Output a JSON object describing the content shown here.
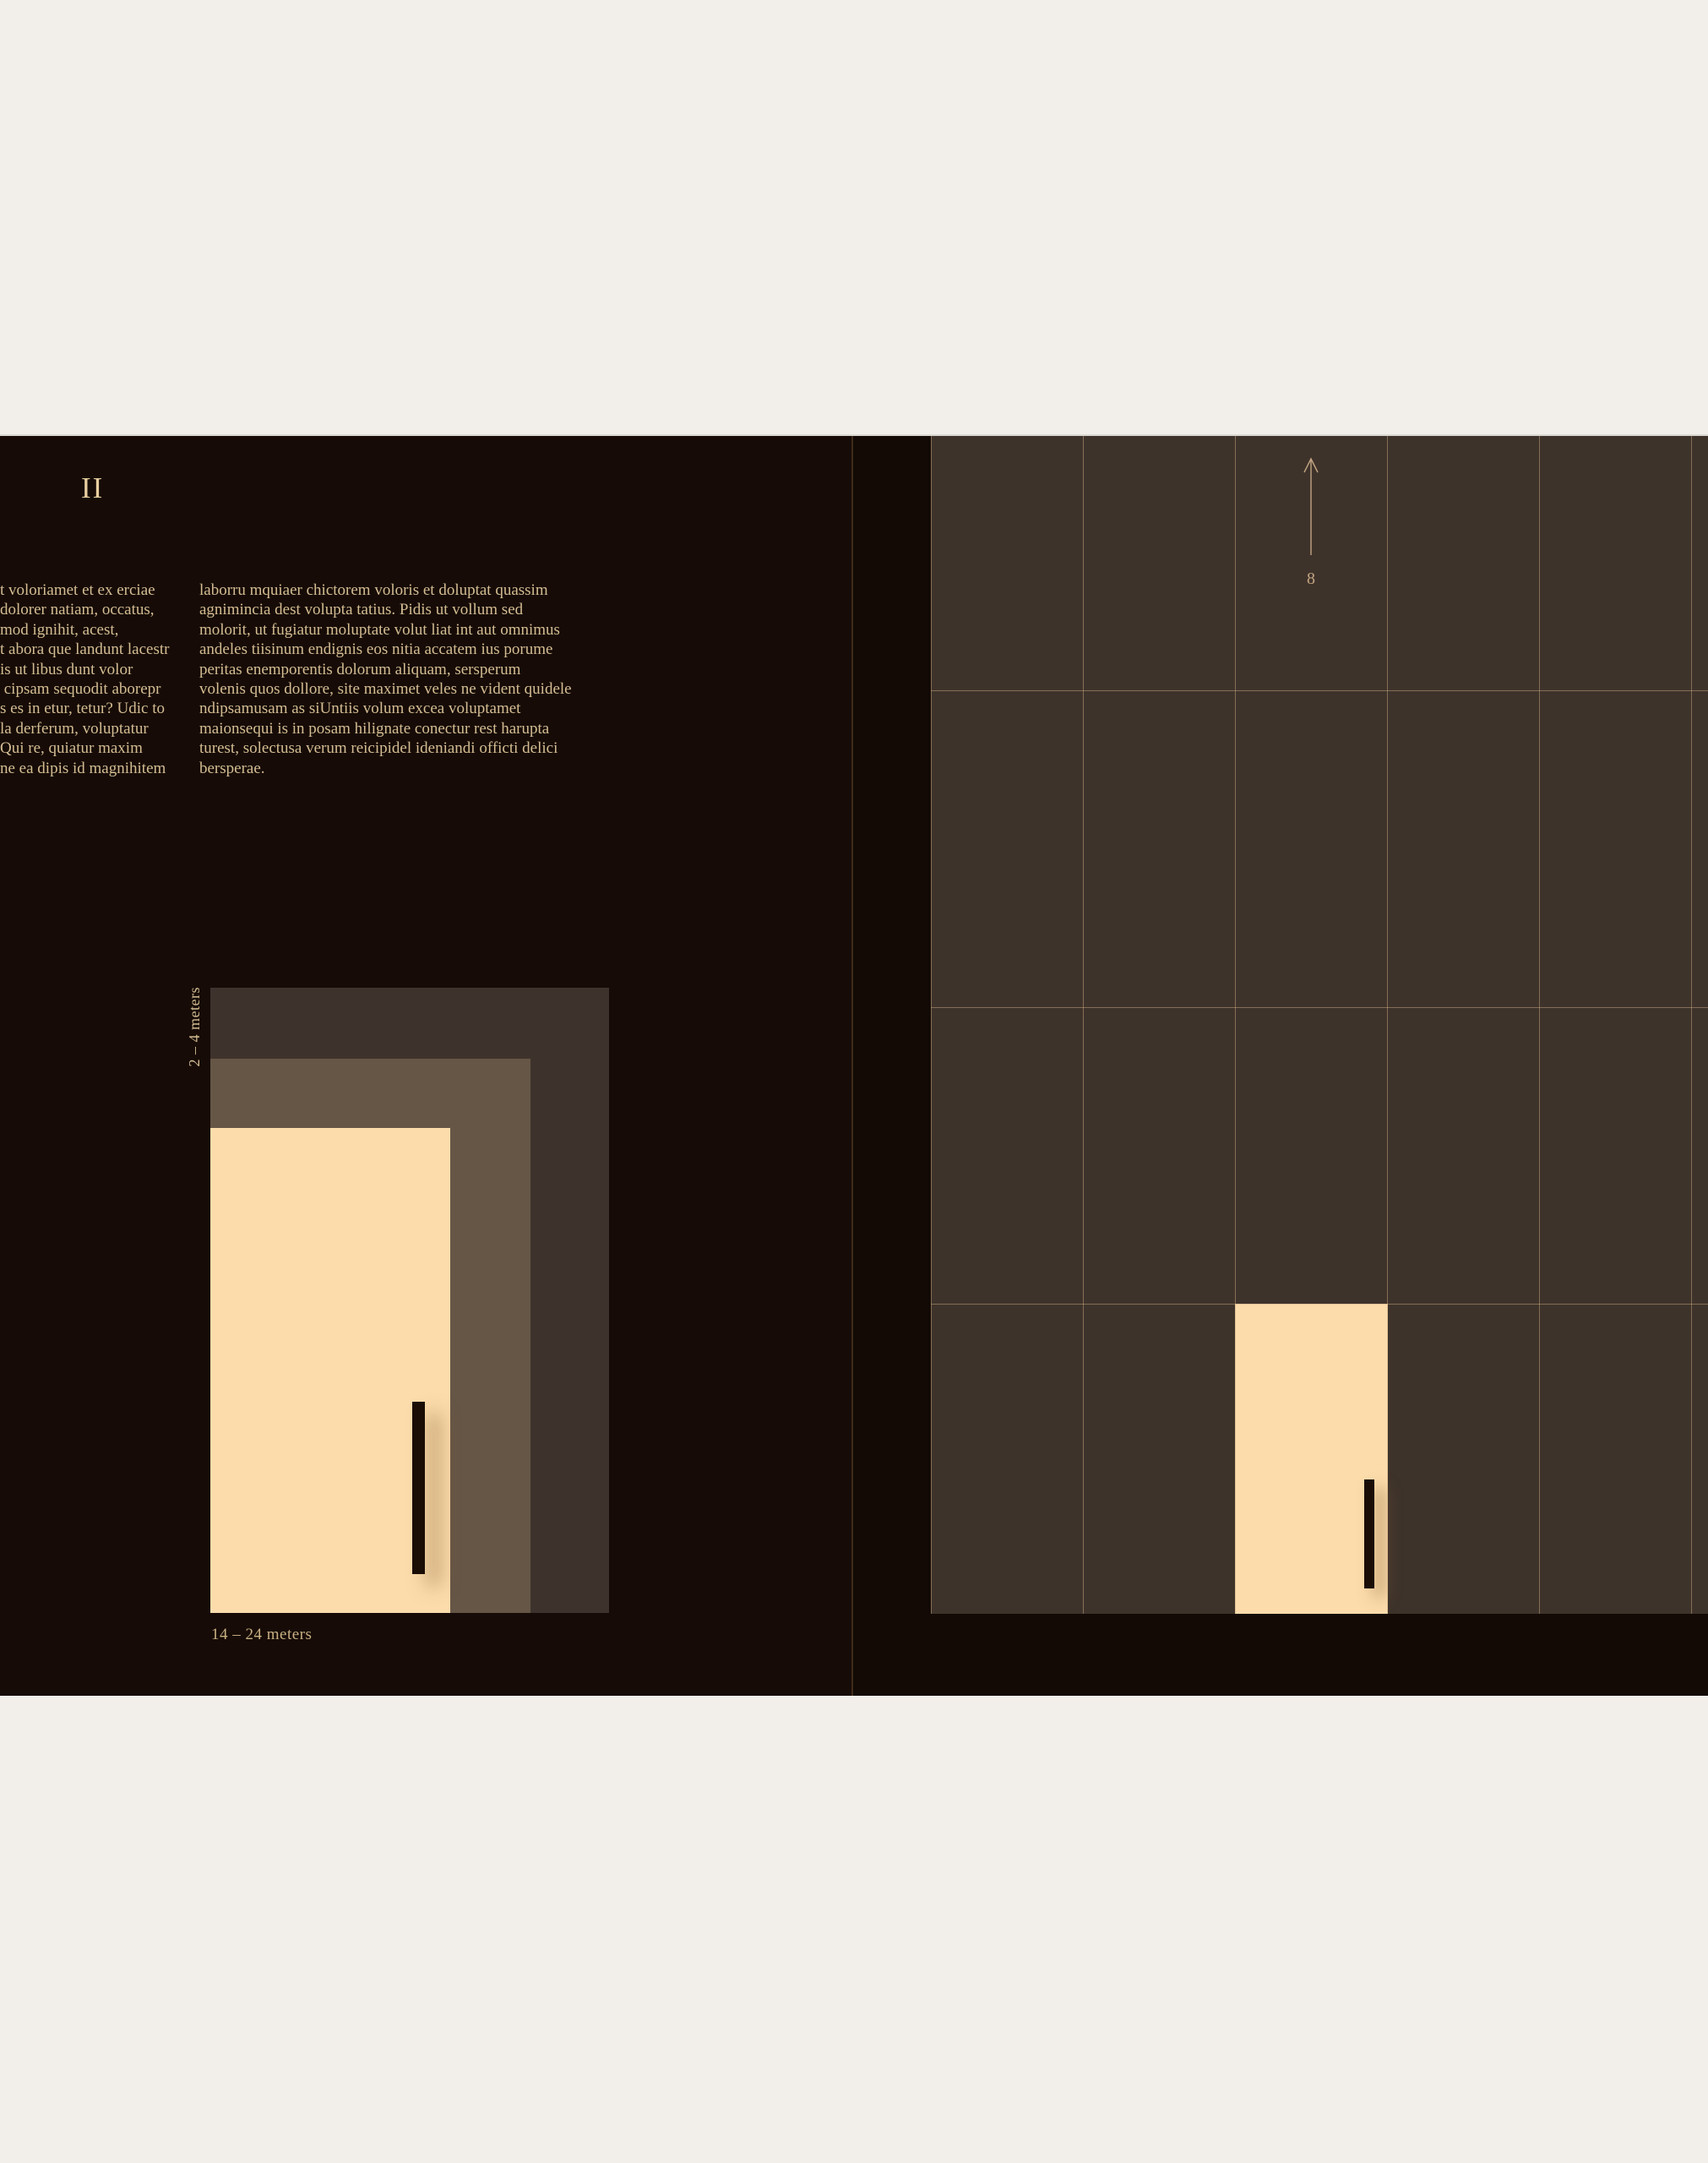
{
  "palette": {
    "canvas_bg": "#f2efea",
    "left_page_bg": "#160b06",
    "right_page_bg": "#130a05",
    "grid_bg": "#3e332b",
    "grid_line": "#c9aa82",
    "diagram_outer": "#3e332c",
    "diagram_middle": "#665646",
    "diagram_inner": "#fcdcab",
    "bar_black": "#1a0d06",
    "body_text": "#d4bd93",
    "numeral_text": "#e9cfa0",
    "annotation_text": "#c2a482"
  },
  "left_page": {
    "numeral": "II",
    "column_1_lines": [
      "t voloriamet et ex erciae",
      "dolorer natiam, occatus,",
      "mod ignihit, acest,",
      "t abora que landunt lacestr",
      "is ut libus dunt volor",
      " cipsam sequodit aborepr",
      "s es in etur, tetur? Udic to",
      "la derferum, voluptatur",
      "Qui re, quiatur maxim",
      "ne ea dipis id magnihitem"
    ],
    "column_2_lines": [
      "laborru mquiaer chictorem voloris et doluptat quassim",
      "agnimincia dest volupta tatius. Pidis ut vollum sed",
      "molorit, ut fugiatur moluptate volut liat int aut omnimus",
      "andeles tiisinum endignis eos nitia accatem ius porume",
      "peritas enemporentis dolorum aliquam, sersperum",
      "volenis quos dollore, site maximet veles ne vident quidele",
      "ndipsamusam as siUntiis volum excea voluptamet",
      "maionsequi is in posam hilignate conectur rest harupta",
      "turest, solectusa verum reicipidel ideniandi officti delici",
      "bersperae."
    ],
    "diagram": {
      "vertical_label": "2 – 4 meters",
      "horizontal_label": "14 – 24 meters",
      "layers": [
        {
          "name": "outer",
          "color": "#3e332c"
        },
        {
          "name": "middle",
          "color": "#665646"
        },
        {
          "name": "inner",
          "color": "#fcdcab"
        }
      ]
    }
  },
  "right_page": {
    "grid": {
      "columns": 5,
      "rows": 4
    },
    "arrow_label": "8",
    "highlight_cell": {
      "column": 3,
      "row": 4,
      "color": "#fcdcab"
    }
  }
}
